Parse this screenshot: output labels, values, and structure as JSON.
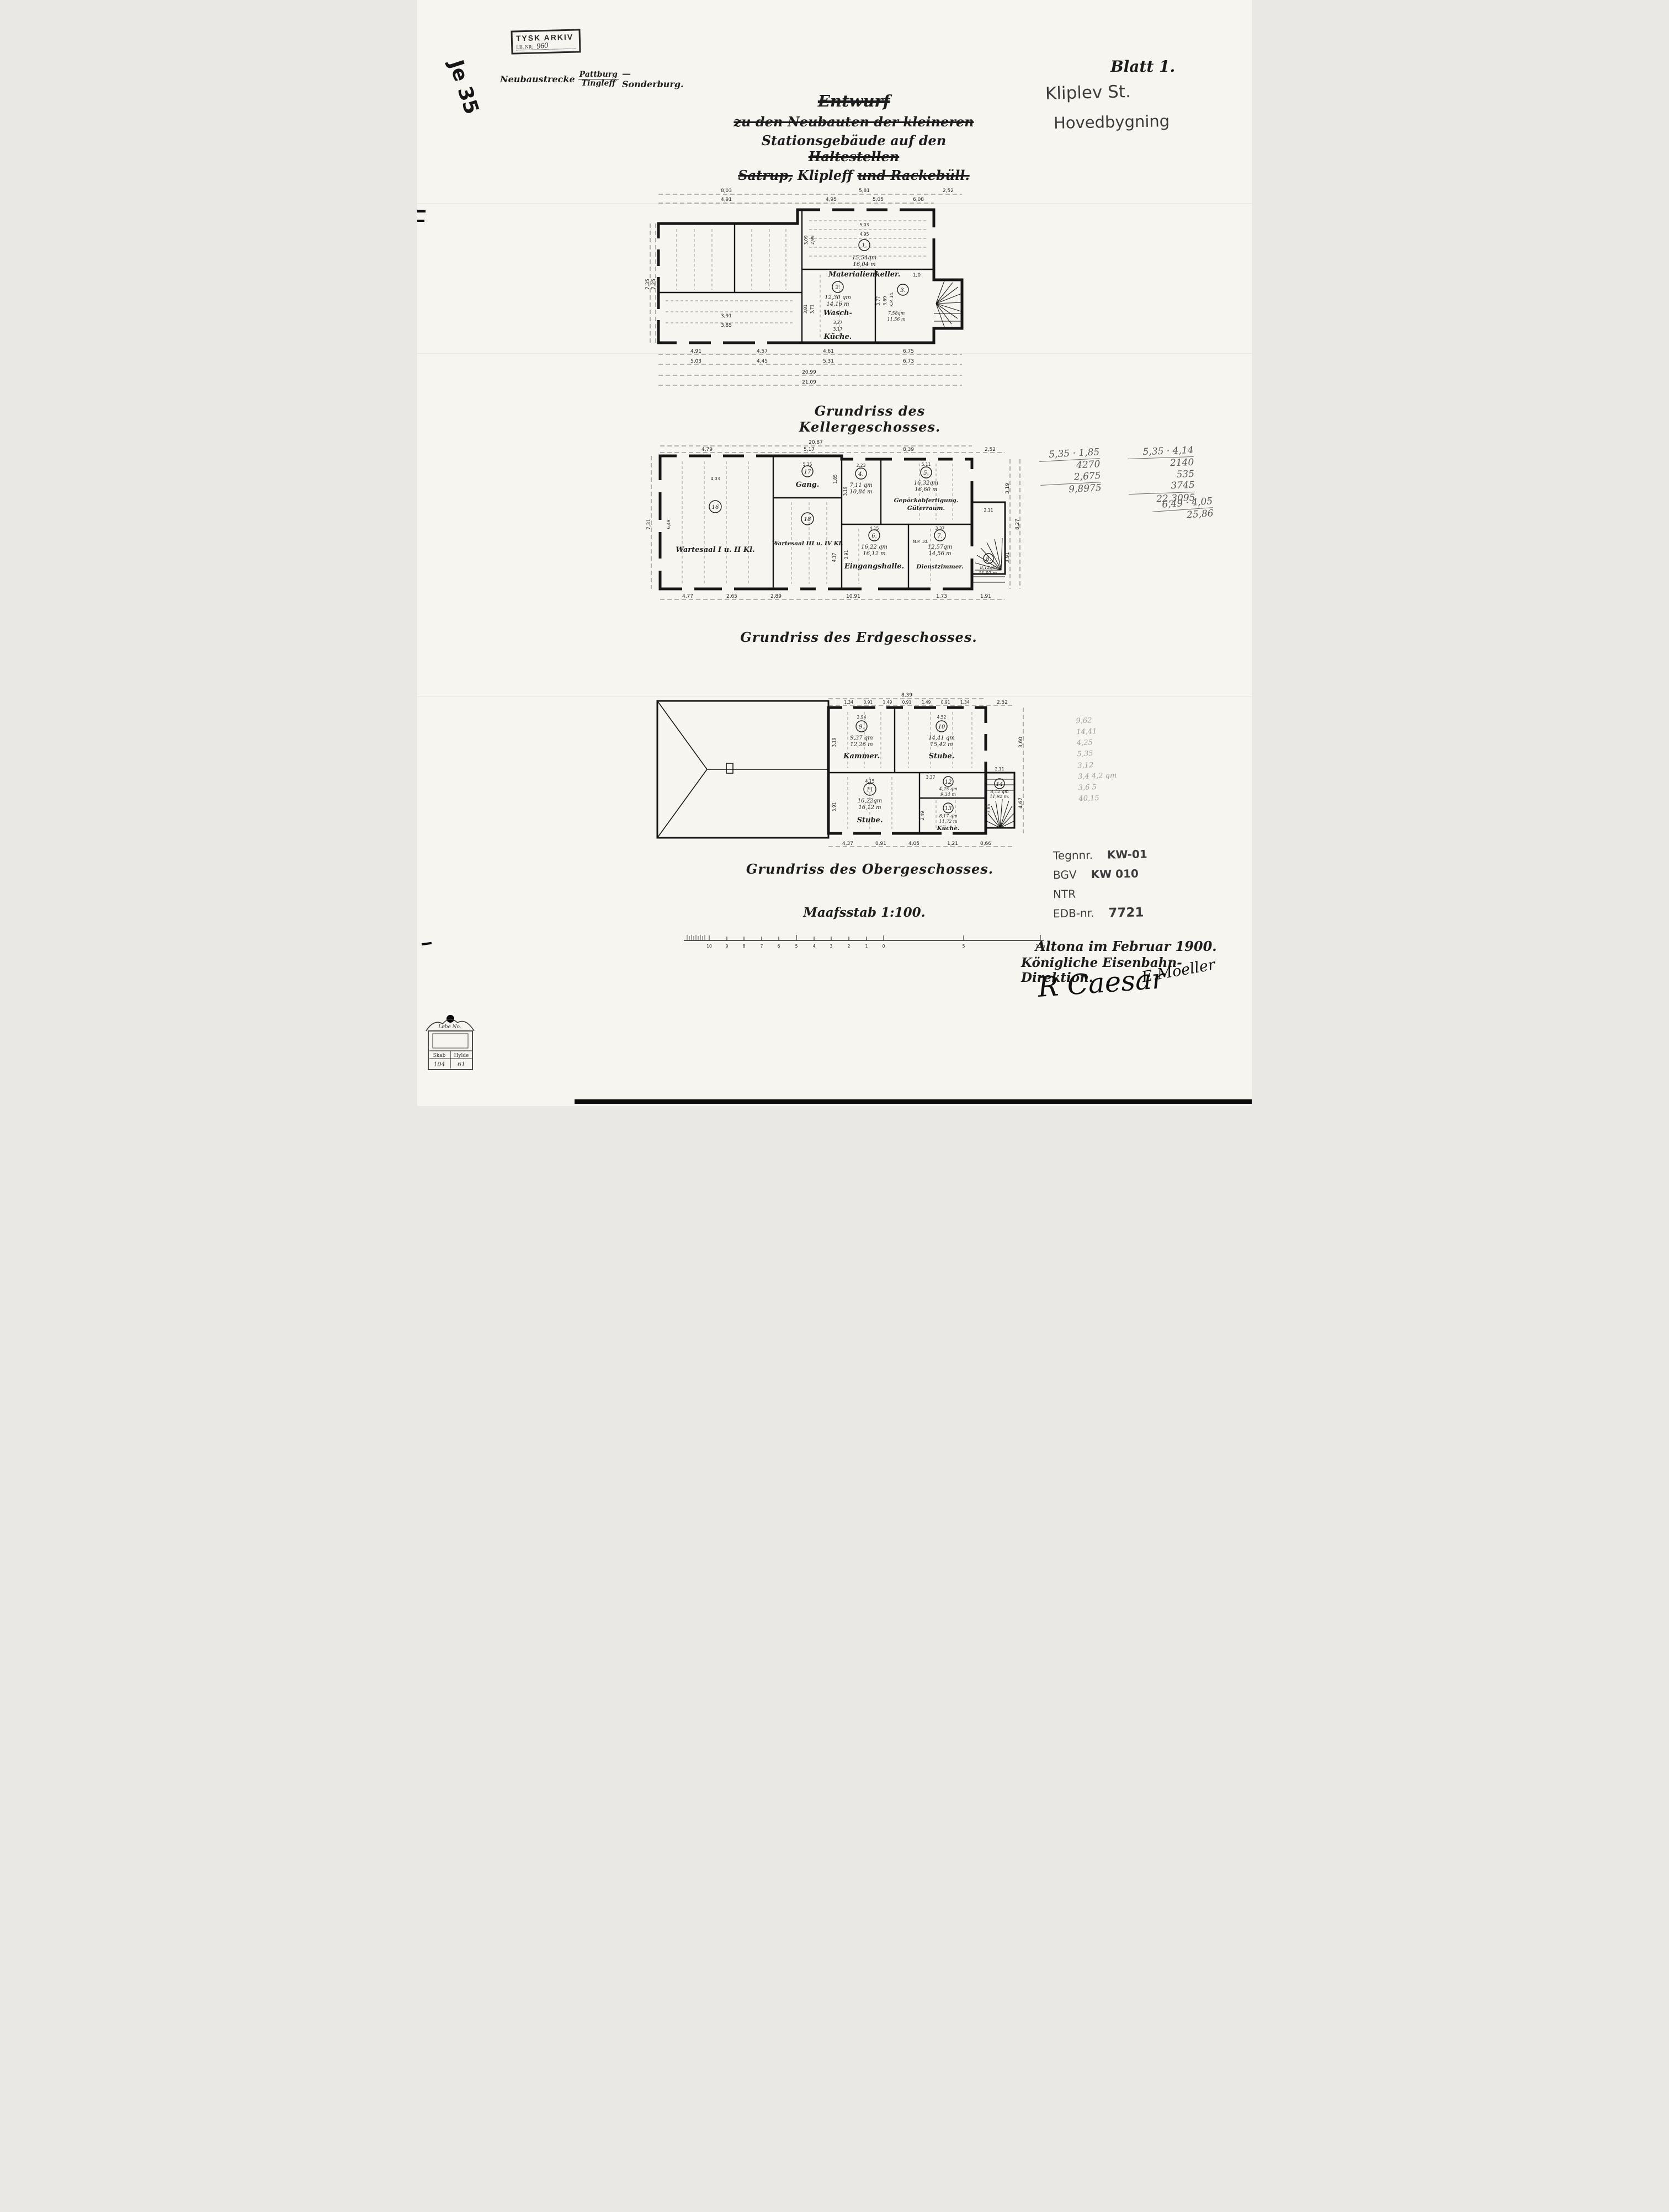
{
  "archive_stamp": {
    "line1": "TYSK ARKIV",
    "lb_label": "LB. NR.",
    "lb_value": "960"
  },
  "route_note": {
    "prefix": "Neubaustrecke",
    "over": "Pattburg",
    "under": "Tingleff",
    "suffix": "— Sonderburg."
  },
  "margin_note": "Je 35",
  "sheet": {
    "blatt": "Blatt 1.",
    "pencil_line1": "Kliplev St.",
    "pencil_line2": "Hovedbygning"
  },
  "title": {
    "l1": "Entwurf",
    "l2": "zu den Neubauten der kleineren",
    "l3a": "Stationsgebäude auf den",
    "l3b": "Haltestellen",
    "l4a": "Satrup,",
    "l4b": "Klipleff",
    "l4c": "und Rackebüll."
  },
  "keller": {
    "caption": "Grundriss des Kellergeschosses.",
    "dims": {
      "top1": "8,03",
      "top2": "5,81",
      "top3": "2,52",
      "top4": "4,91",
      "top5": "4,95",
      "top6": "5,05",
      "top7": "6,08",
      "left1": "7,35",
      "left2": "7,25",
      "b1": "4,91",
      "b2": "4,57",
      "b3": "4,61",
      "b4": "6,75",
      "b5": "5,03",
      "b6": "4,45",
      "b7": "5,31",
      "b8": "6,73",
      "total1": "20,99",
      "total2": "21,09",
      "inner1": "3,91",
      "inner2": "3,85",
      "door": "1,0"
    },
    "r1": {
      "no": "1.",
      "area": "15,54qm",
      "umfang": "16,04 m",
      "name": "Materialienkeller.",
      "w1": "5,03",
      "w2": "4,95",
      "h1": "3,09",
      "h2": "2,99"
    },
    "r2": {
      "no": "2.",
      "area": "12,30 qm",
      "umfang": "14,16 m",
      "name1": "Wasch-",
      "name2": "Küche.",
      "w1": "3,27",
      "w2": "3,17",
      "h1": "3,81",
      "h2": "3,71"
    },
    "r3": {
      "no": "3.",
      "area": "7,58qm",
      "umfang": "11,56 m",
      "h1": "3,77",
      "h2": "3,69",
      "note": "K.P. 14."
    }
  },
  "erdgeschoss": {
    "caption": "Grundriss des Erdgeschosses.",
    "dims": {
      "total": "20,87",
      "top1": "4,79",
      "top2": "5,17",
      "top3": "8,39",
      "top4": "2,52",
      "left": "7,31",
      "right1": "3,19",
      "right2": "3,91",
      "right3": "8,27",
      "b1": "4,77",
      "b2": "2,65",
      "b3": "2,89",
      "b4": "10,91",
      "b5": "1,73",
      "b6": "1,91"
    },
    "r16": {
      "no": "16",
      "name": "Wartesaal I u. II Kl.",
      "w": "4,03",
      "h": "6,49"
    },
    "r17": {
      "no": "17",
      "name": "Gang.",
      "w": "5,35",
      "h": "1,85"
    },
    "r18": {
      "no": "18",
      "name": "Wartesaal III u. IV Kl.",
      "h": "4,17"
    },
    "r4": {
      "no": "4.",
      "area": "7,11 qm",
      "umfang": "10,84 m",
      "w": "2,23",
      "h": "3,19"
    },
    "r5": {
      "no": "5.",
      "area": "16,32qm",
      "umfang": "16,60 m",
      "name1": "Gepäckabfertigung.",
      "name2": "Güterraum.",
      "w": "5,11"
    },
    "r6": {
      "no": "6.",
      "area": "16,22 qm",
      "umfang": "16,12 m",
      "name": "Eingangshalle.",
      "w": "4,15",
      "h": "3,91"
    },
    "r7": {
      "no": "7.",
      "area": "12,57qm",
      "umfang": "14,56 m",
      "name": "Dienstzimmer.",
      "w": "3,37",
      "note": "N.P. 10."
    },
    "r8": {
      "no": "8.",
      "area": "8,12qm",
      "umfang": "11,92 m.",
      "w": "2,11"
    }
  },
  "obergeschoss": {
    "caption": "Grundriss des Obergeschosses.",
    "dims": {
      "total": "8,39",
      "subdiv": "1,34 0,91 1,49 0,91 1,49 0,91 1,34",
      "right_top": "2,52",
      "right1": "3,60",
      "right2": "4,67",
      "b1": "4,37",
      "b2": "0,91",
      "b3": "4,05",
      "b4": "1,21",
      "b5": "0,66"
    },
    "r9": {
      "no": "9.",
      "area": "9,37 qm",
      "umfang": "12,26 m",
      "name": "Kammer.",
      "w": "2,94",
      "h": "3,19"
    },
    "r10": {
      "no": "10",
      "area": "14,41 qm",
      "umfang": "15,42 m",
      "name": "Stube.",
      "w": "4,52"
    },
    "r11": {
      "no": "11",
      "area": "16,22qm",
      "umfang": "16,12 m",
      "name": "Stube.",
      "w": "4,15",
      "h": "3,91"
    },
    "r12": {
      "no": "12",
      "area": "4,25 qm",
      "umfang": "9,34 m",
      "w": "3,37"
    },
    "r13": {
      "no": "13",
      "area": "8,17 qm",
      "umfang": "11,72 m",
      "name": "Küche.",
      "h": "2,49"
    },
    "r14": {
      "no": "14",
      "area": "8,12 qm",
      "umfang": "11,92 m.",
      "w": "2,11",
      "h": "3,85"
    }
  },
  "scale_note": "Maafsstab 1:100.",
  "scale_bar": {
    "labels": [
      "10",
      "9",
      "8",
      "7",
      "6",
      "5",
      "4",
      "3",
      "2",
      "1",
      "0",
      "5",
      "10m"
    ]
  },
  "calc": {
    "c1": {
      "top": "5,35 · 1,85",
      "m1": "4270",
      "m2": "2,675",
      "result": "9,8975"
    },
    "c2": {
      "top": "5,35 · 4,14",
      "m1": "2140",
      "m2": "535",
      "m3": "3745",
      "result": "22,3095"
    },
    "c3": {
      "top": "6,49 · 4,05",
      "result": "25,86"
    }
  },
  "pencil_column": {
    "l1": "9,62",
    "l2": "14,41",
    "l3": "4,25",
    "l4": "5,35",
    "l5": "3,12",
    "l6": "3,4  4,2 qm",
    "l7": "3,6 5",
    "l8": "40,15"
  },
  "registry": {
    "r1_label": "Tegnnr.",
    "r1_value": "KW-01",
    "r2_label": "BGV",
    "r2_value": "KW 010",
    "r3_label": "NTR",
    "r4_label": "EDB-nr.",
    "r4_value": "7721"
  },
  "footer": {
    "place_date": "Altona im Februar 1900.",
    "authority": "Königliche Eisenbahn-Direktion.",
    "sig1": "R Caesar",
    "sig2": "E.Moeller"
  },
  "corner_stamp": {
    "title": "Løbe No.",
    "col1": "Skab",
    "col2": "Hylde",
    "v1": "104",
    "v2": "61"
  }
}
